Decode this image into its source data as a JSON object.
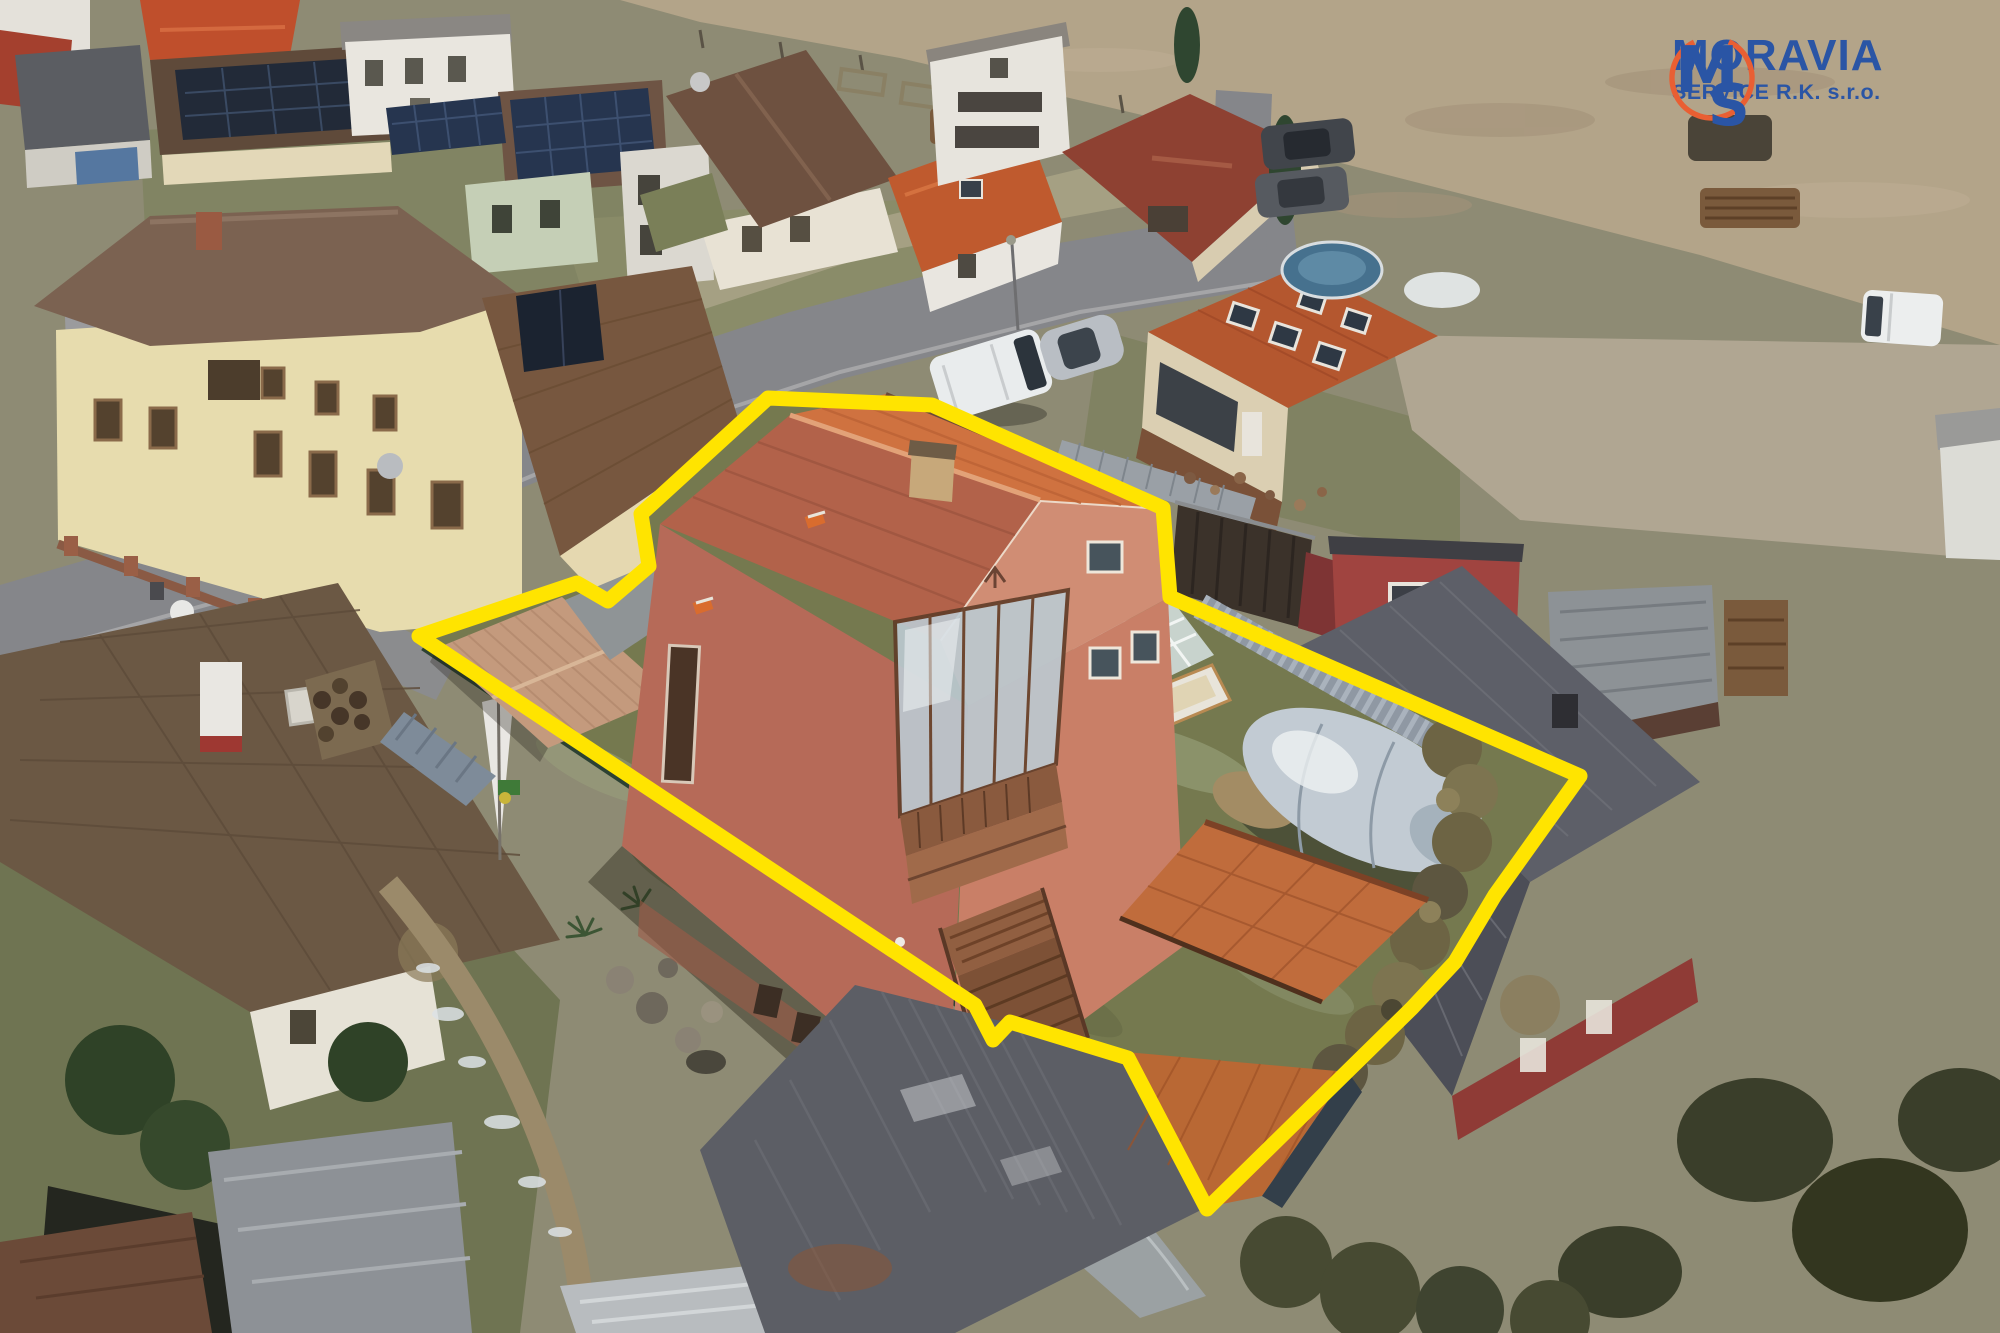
{
  "logo": {
    "monogram_m": "M",
    "monogram_s": "S",
    "line1": "MORAVIA",
    "line2": "SERVICE R.K. s.r.o.",
    "brand_blue": "#2a55a5",
    "brand_orange": "#e95f33"
  },
  "property": {
    "outline_points": "768,398 932,405 1163,508 1170,597 1580,776 1495,895 1455,962 1412,1008 1207,1209 1128,1058 1010,1022 993,1040 975,1005 419,636 577,583 608,601 649,566 641,514",
    "outline_color": "#ffe400",
    "outline_width": 15
  },
  "palette": {
    "field_tan": "#b3a489",
    "road_gray": "#85868a",
    "lawn_olive": "#75794f",
    "main_roof_orange": "#cf7240",
    "main_roof_shade": "#b2624a",
    "house_wall_salmon": "#b96b58",
    "house_gable_pink": "#d08d74",
    "garage_roof_weathered": "#c49a7d",
    "pool_cover_gray": "#c2cbd3",
    "hedge_olive": "#6d6444",
    "fence_green": "#2c4133",
    "slat_fence_gray": "#97a0aa",
    "neighbor_roof_brown": "#6b5844",
    "red_house_wall": "#99403a",
    "red_house_roof": "#565861"
  },
  "scene": {
    "type": "aerial-drone-photo",
    "subject": "family house with garden, pool and outbuildings marked by yellow parcel outline",
    "objects": [
      "main-house",
      "garage",
      "greenhouse",
      "pool-with-cover",
      "outbuilding",
      "hedge",
      "garden-fence",
      "neighbor-houses",
      "solar-roof-houses",
      "field",
      "street",
      "parked-van",
      "parked-cars",
      "trees"
    ]
  }
}
